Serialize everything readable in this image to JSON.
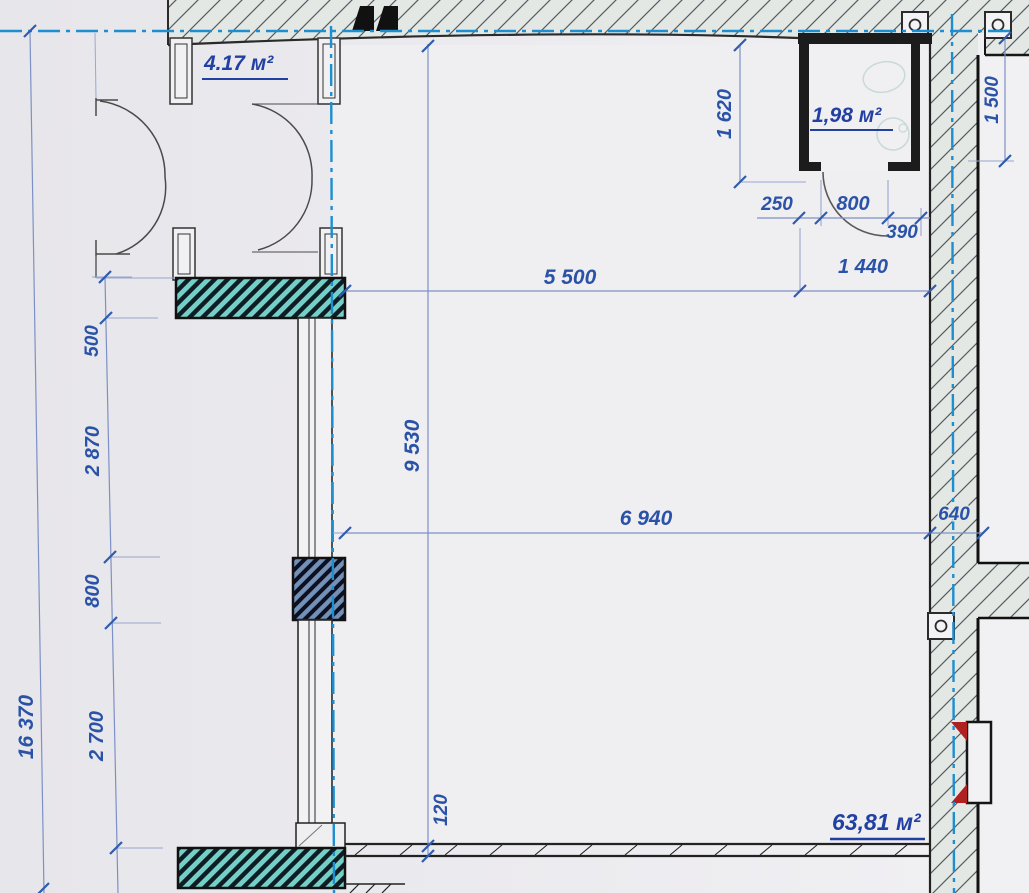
{
  "plan": {
    "areas": {
      "vestibule": "4.17 м²",
      "wc": "1,98 м²",
      "main": "63,81 м²"
    },
    "dims": {
      "v1620": "1 620",
      "h250": "250",
      "h800": "800",
      "h390": "390",
      "h5500": "5 500",
      "h1440": "1 440",
      "v1500": "1 500",
      "v9530": "9 530",
      "h6940": "6 940",
      "h640": "640",
      "v500": "500",
      "v2870": "2 870",
      "v800": "800",
      "v2700": "2 700",
      "v16370": "16 370",
      "v120": "120"
    },
    "colors": {
      "paper": "#eceaee",
      "dimension_blue": "#2a53a8",
      "axis_blue": "#1d8ed0",
      "wall_black": "#1c1c1c",
      "teal_wall": "#74cfc9",
      "pier_blue": "#7391b6",
      "band_fill": "#e3e8e4",
      "marker_red": "#b02020"
    }
  }
}
